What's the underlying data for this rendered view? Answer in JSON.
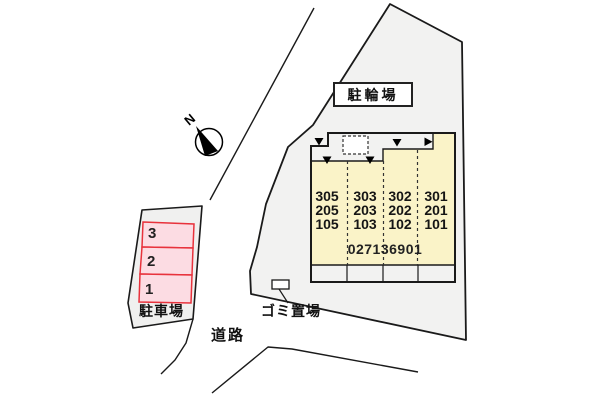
{
  "diagram": {
    "bicycle_parking_label": "駐輪場",
    "building": {
      "columns": [
        {
          "units": [
            "305",
            "205",
            "105"
          ]
        },
        {
          "units": [
            "303",
            "203",
            "103"
          ]
        },
        {
          "units": [
            "302",
            "202",
            "102"
          ]
        },
        {
          "units": [
            "301",
            "201",
            "101"
          ]
        }
      ],
      "building_number": "027136901"
    },
    "parking": {
      "label": "駐車場",
      "space_numbers": [
        "3",
        "2",
        "1"
      ]
    },
    "garbage_label": "ゴミ置場",
    "road_label": "道路",
    "compass": {
      "north_label": "N"
    }
  },
  "colors": {
    "site_fill": "#f2f2f1",
    "building_fill": "#faf3c8",
    "parking_space_fill": "#fcdce3",
    "parking_space_border": "#e8323c",
    "outline": "#1a1a1a"
  }
}
